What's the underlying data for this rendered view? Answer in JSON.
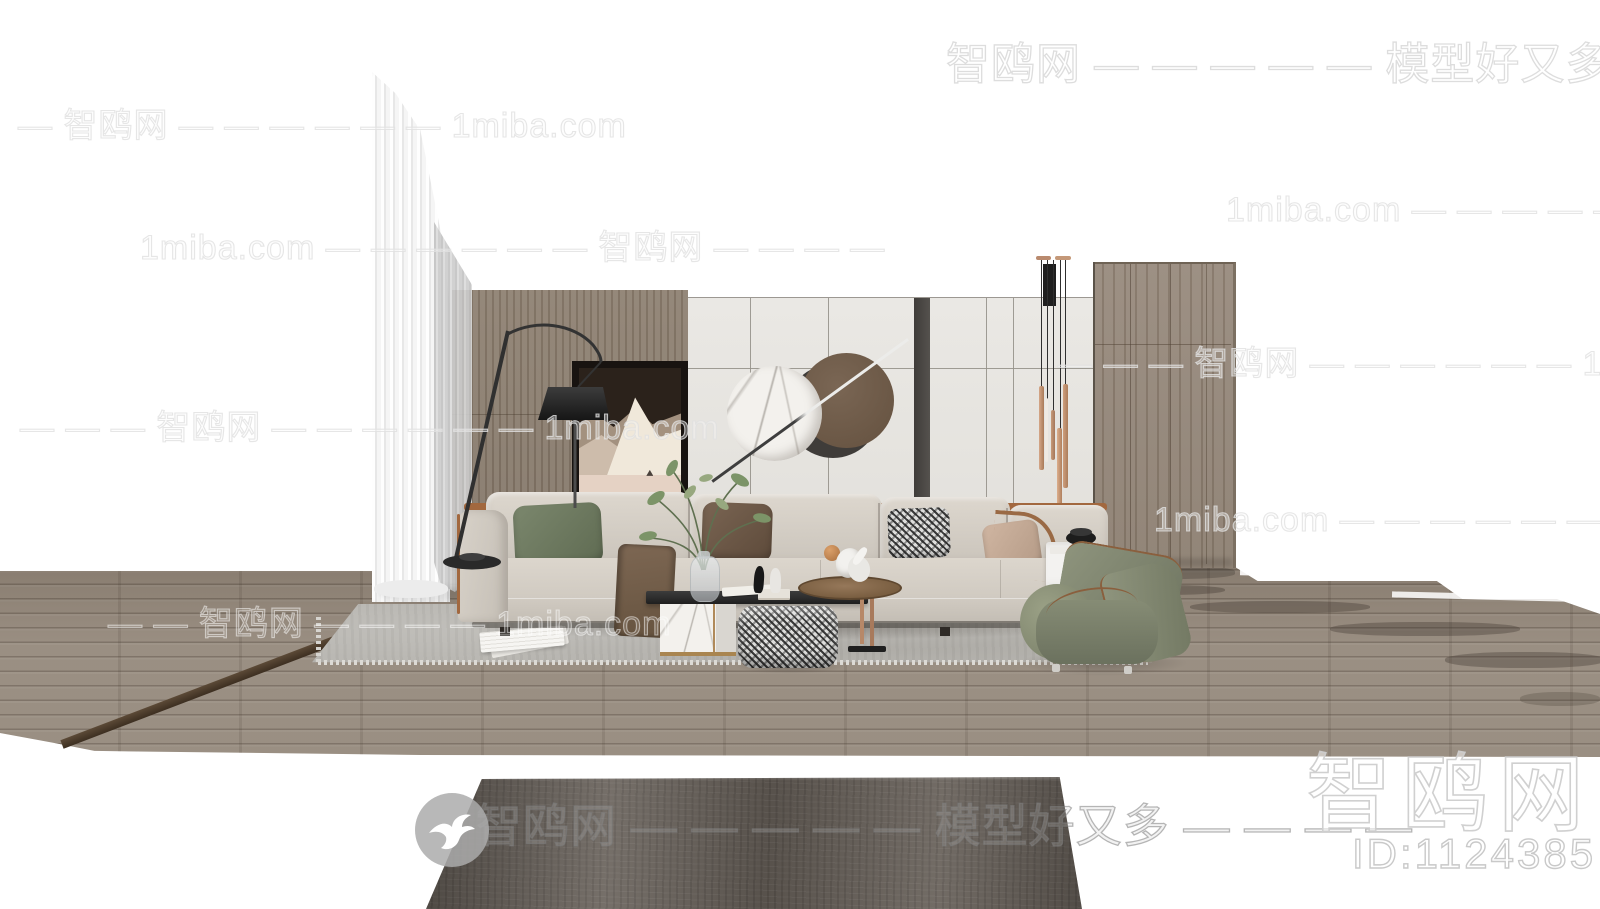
{
  "brand": {
    "site_name": "智鸥网",
    "tagline": "模型好又多",
    "alt_domain": "1miba.com",
    "model_id": "ID:1124385"
  },
  "watermarks": {
    "top_right": "智鸥网 — — — — — 模型好又多 —",
    "row_left_1": "— 智鸥网 — — — — — — 1miba.com",
    "row_right_1": "1miba.com — — — — — — 智鸥网 — —",
    "row_left_2": "1miba.com — — — — — — 智鸥网 — — — —",
    "row_right_2": "— — — 智鸥网 — — — — — — 1miba.com",
    "row_left_3": "— — — 智鸥网 — — — — — — 1miba.com",
    "row_right_3": "1miba.com — — — — — — 智鸥网 — — — — — —",
    "row_floor": "— — 智鸥网 — — — — 1miba.com",
    "bottom_center": "智鸥网 — — — — — 模型好又多 — — — —",
    "bottom_right_brand": "智鸥网",
    "bottom_right_id": "ID:1124385"
  },
  "colors": {
    "floor_wood": "#95897c",
    "wall_wood": "#8f8273",
    "wall_panel": "#e8e6e2",
    "accent_copper": "#c29277",
    "sofa_fabric": "#d7d1c8",
    "leather_trim": "#a2683f",
    "pillow_green": "#6f7b61",
    "pillow_brown": "#6e5a49",
    "chair_green": "#838a72",
    "area_rug_gray": "#bab8b3",
    "front_rug_dark": "#665f58",
    "table_black": "#2c2c2c",
    "marble_white": "#f3f1ed",
    "brass": "#b08a5a"
  }
}
